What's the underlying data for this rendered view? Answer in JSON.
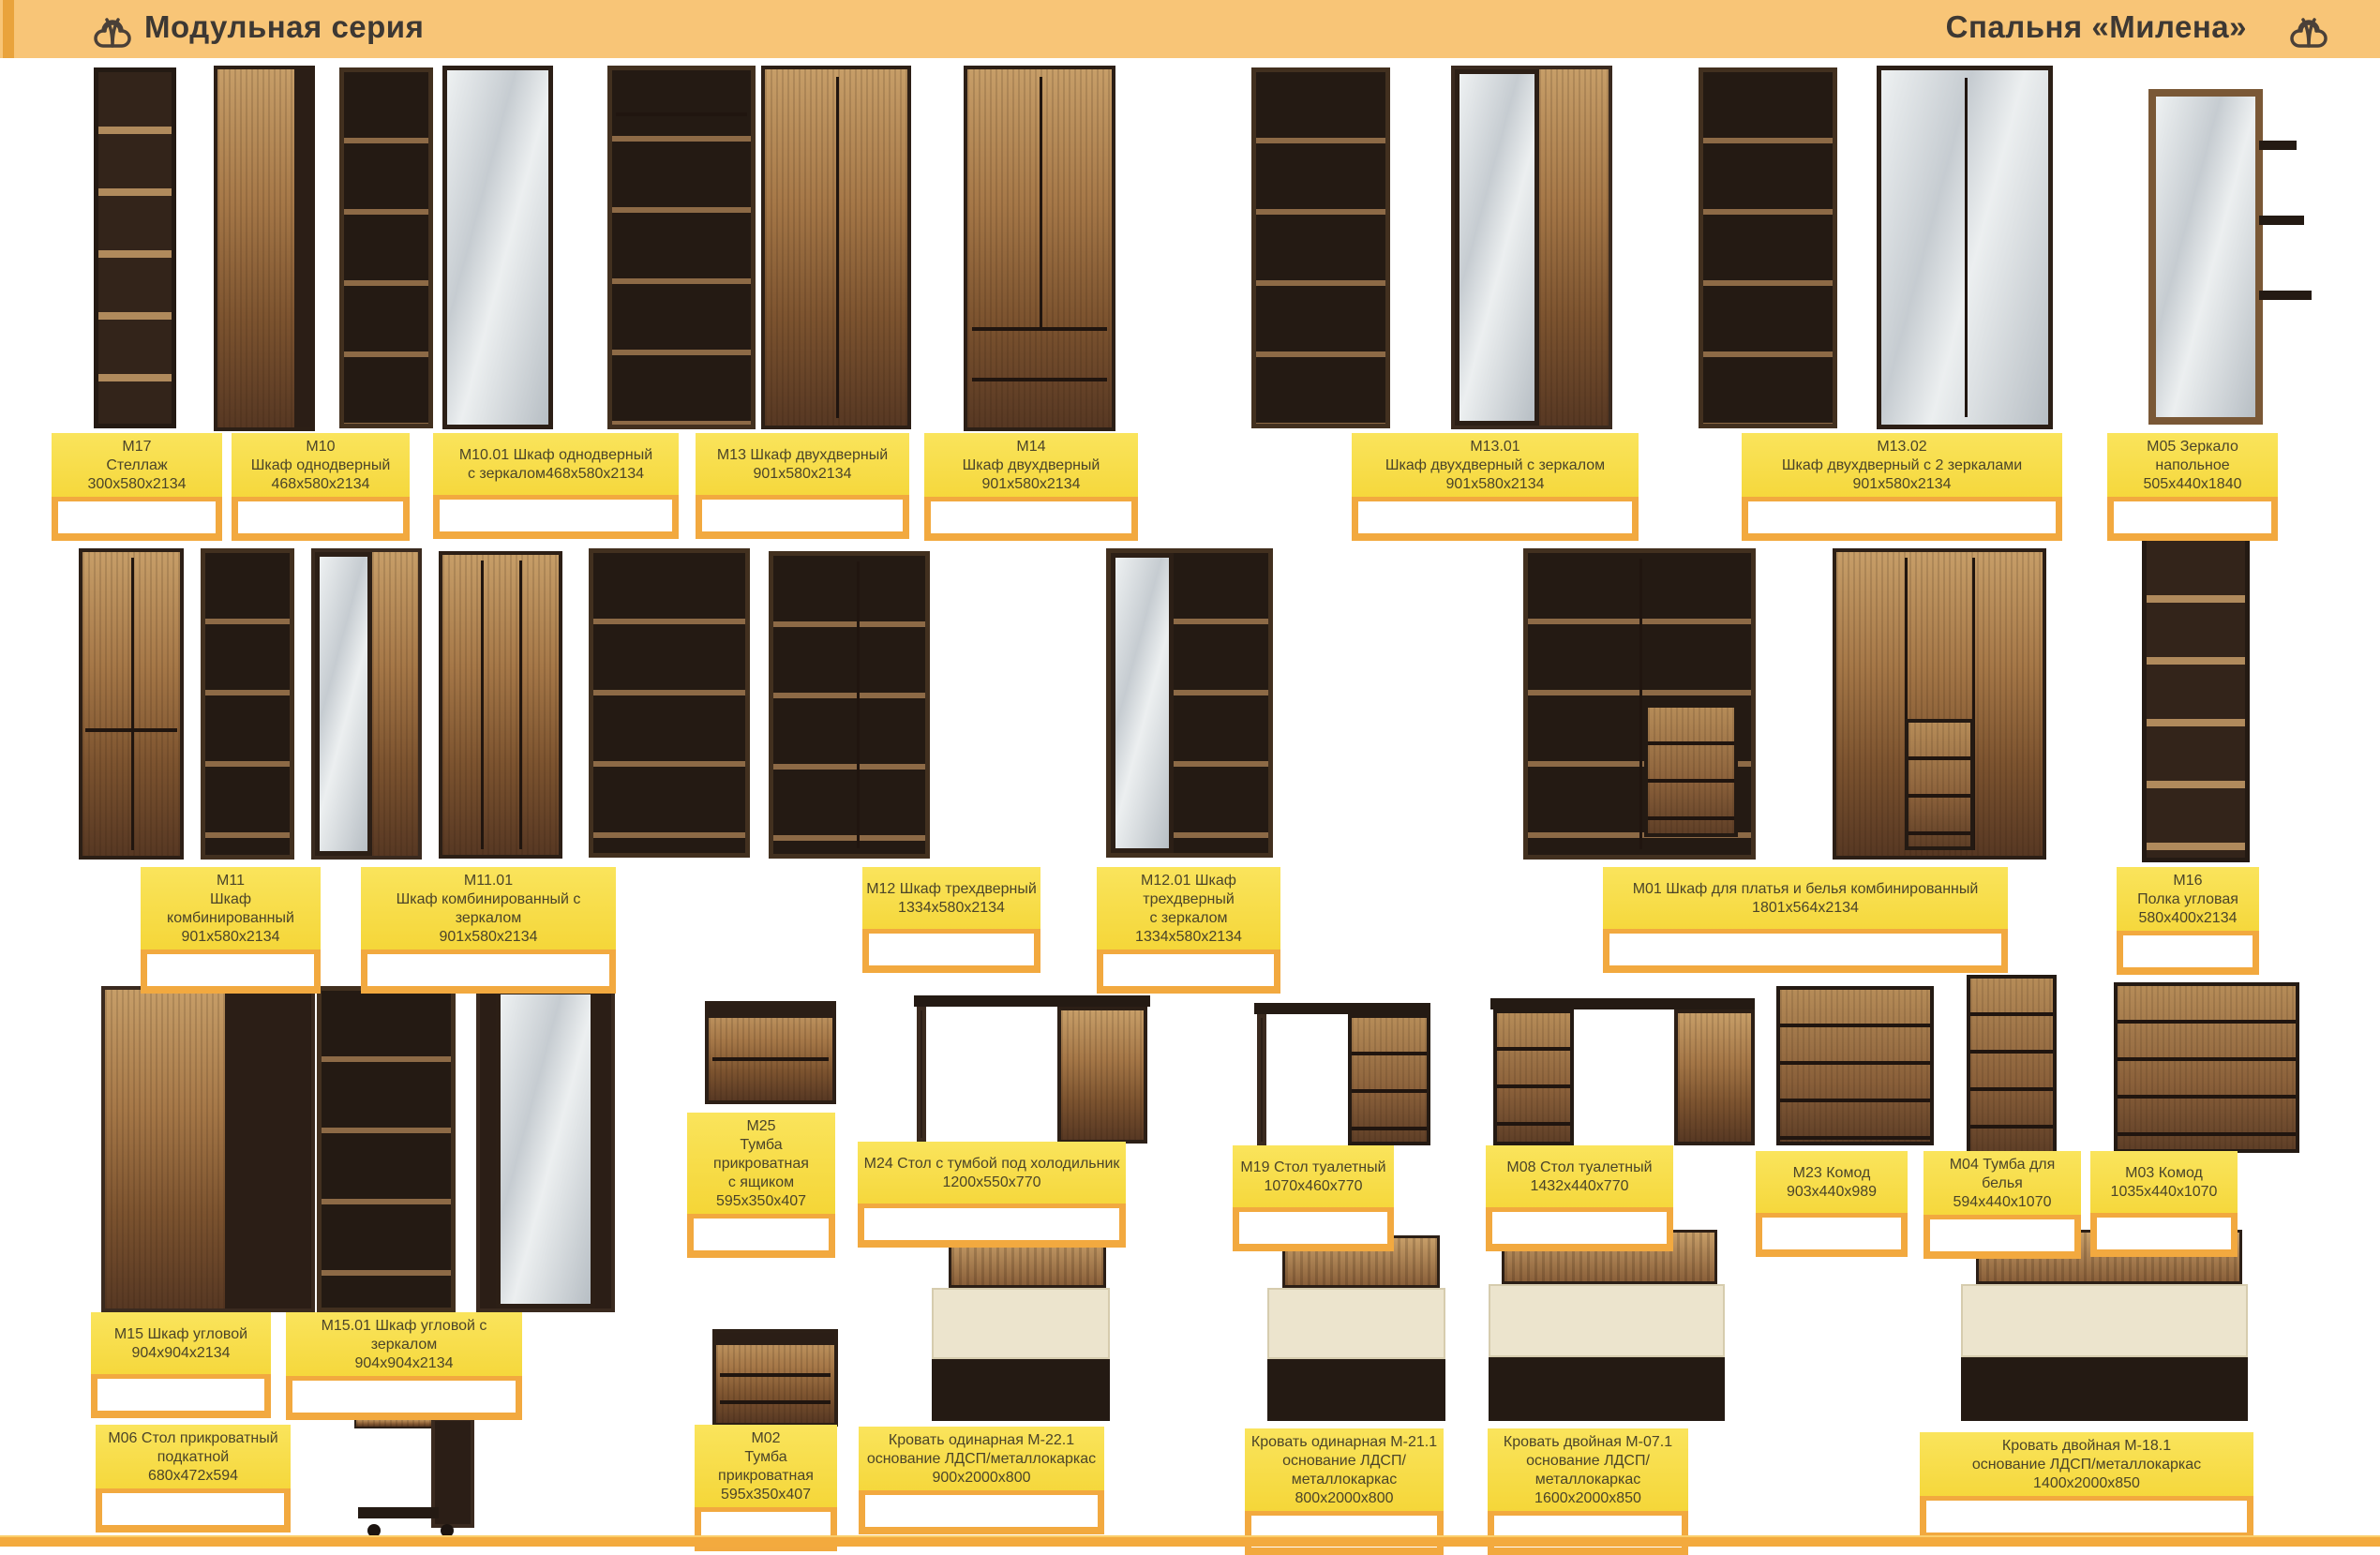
{
  "header": {
    "left_title": "Модульная серия",
    "right_title": "Спальня «Милена»",
    "left_logo": "brand-logo",
    "right_logo": "brand-logo"
  },
  "colors": {
    "header_bg": "#F8C577",
    "label_bg": "#F5D635",
    "price_frame": "#F2A93F",
    "footer_bar": "#F3AA3E"
  },
  "price_field": {
    "value": ""
  },
  "products": [
    {
      "lines": [
        "М17",
        "Стеллаж",
        "300х580х2134"
      ]
    },
    {
      "lines": [
        "М10",
        "Шкаф однодверный",
        "468х580х2134"
      ]
    },
    {
      "lines": [
        "М10.01 Шкаф однодверный",
        "с зеркалом468х580х2134"
      ]
    },
    {
      "lines": [
        "М13 Шкаф двухдверный",
        "901х580х2134"
      ]
    },
    {
      "lines": [
        "М14",
        "Шкаф двухдверный",
        "901х580х2134"
      ]
    },
    {
      "lines": [
        "М13.01",
        "Шкаф двухдверный с зеркалом",
        "901х580х2134"
      ]
    },
    {
      "lines": [
        "М13.02",
        "Шкаф двухдверный с 2 зеркалами",
        "901х580х2134"
      ]
    },
    {
      "lines": [
        "М05 Зеркало",
        "напольное",
        "505х440х1840"
      ]
    },
    {
      "lines": [
        "М11",
        "Шкаф комбинированный",
        "901х580х2134"
      ]
    },
    {
      "lines": [
        "М11.01",
        "Шкаф комбинированный с зеркалом",
        "901х580х2134"
      ]
    },
    {
      "lines": [
        "М12 Шкаф трехдверный",
        "1334х580х2134"
      ]
    },
    {
      "lines": [
        "М12.01 Шкаф трехдверный",
        "с зеркалом",
        "1334х580х2134"
      ]
    },
    {
      "lines": [
        "М01 Шкаф для платья и белья комбинированный",
        "1801х564х2134"
      ]
    },
    {
      "lines": [
        "М16",
        "Полка угловая",
        "580х400х2134"
      ]
    },
    {
      "lines": [
        "М15 Шкаф угловой",
        "904х904х2134"
      ]
    },
    {
      "lines": [
        "М15.01 Шкаф угловой с зеркалом",
        "904х904х2134"
      ]
    },
    {
      "lines": [
        "М25",
        "Тумба прикроватная",
        "с ящиком",
        "595х350х407"
      ]
    },
    {
      "lines": [
        "М24 Стол с тумбой под холодильник",
        "1200х550х770"
      ]
    },
    {
      "lines": [
        "М19 Стол туалетный",
        "1070х460х770"
      ]
    },
    {
      "lines": [
        "М08 Стол туалетный",
        "1432х440х770"
      ]
    },
    {
      "lines": [
        "М23 Комод",
        "903х440х989"
      ]
    },
    {
      "lines": [
        "М04 Тумба для белья",
        "594х440х1070"
      ]
    },
    {
      "lines": [
        "М03 Комод",
        "1035х440х1070"
      ]
    },
    {
      "lines": [
        "М06 Стол прикроватный",
        "подкатной",
        "680х472х594"
      ]
    },
    {
      "lines": [
        "М02",
        "Тумба прикроватная",
        "595х350х407"
      ]
    },
    {
      "lines": [
        "Кровать одинарная М-22.1",
        "основание ЛДСП/металлокаркас",
        "900х2000х800"
      ]
    },
    {
      "lines": [
        "Кровать одинарная М-21.1",
        "основание ЛДСП/металлокаркас",
        "800х2000х800"
      ]
    },
    {
      "lines": [
        "Кровать двойная М-07.1",
        "основание ЛДСП/металлокаркас",
        "1600х2000х850"
      ]
    },
    {
      "lines": [
        "Кровать двойная М-18.1",
        "основание ЛДСП/металлокаркас",
        "1400х2000х850"
      ]
    }
  ]
}
